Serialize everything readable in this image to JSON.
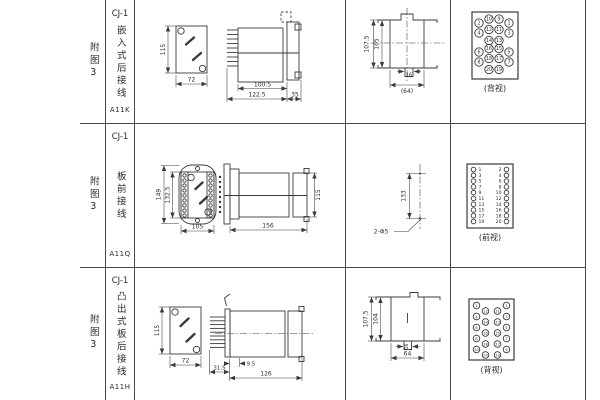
{
  "colors": {
    "background": "#ffffff",
    "line": "#3a3a3a",
    "text": "#2b2b2b"
  },
  "rows": [
    {
      "fig": "附图3",
      "model": "CJ-1",
      "mount_type": "嵌入式后接线",
      "code": "A11K",
      "front": {
        "height": "115",
        "width": "72"
      },
      "side": {
        "body_depth": "100.5",
        "total_depth": "122.5",
        "flange_depth": "35"
      },
      "cutout": {
        "outer_height": "107.5",
        "inner_height": "105",
        "tab": "16",
        "width": "(64)"
      },
      "terminal_view": {
        "caption": "(背视)",
        "numbers": [
          "2",
          "10",
          "9",
          "1",
          "4",
          "12",
          "11",
          "3",
          "14",
          "13",
          "6",
          "16",
          "15",
          "5",
          "8",
          "18",
          "17",
          "7",
          "20",
          "19"
        ]
      }
    },
    {
      "fig": "附图3",
      "model": "CJ-1",
      "mount_type": "板前接线",
      "code": "A11Q",
      "front": {
        "outer_height": "149",
        "inner_height": "132.5",
        "width": "105"
      },
      "side": {
        "length": "156",
        "height": "115"
      },
      "holes": {
        "pitch": "133",
        "label": "2-Φ5"
      },
      "terminal_view": {
        "caption": "(前视)",
        "numbers": [
          "1",
          "3",
          "5",
          "7",
          "9",
          "11",
          "13",
          "15",
          "17",
          "19",
          "2",
          "4",
          "6",
          "8",
          "10",
          "12",
          "14",
          "16",
          "18",
          "20"
        ]
      }
    },
    {
      "fig": "附图3",
      "model": "CJ-1",
      "mount_type": "凸出式板后接线",
      "code": "A11H",
      "front": {
        "height": "115",
        "width": "72"
      },
      "side": {
        "pin_depth": "31.5",
        "offset": "9.5",
        "length": "126"
      },
      "cutout": {
        "outer_height": "107.5",
        "inner_height": "104",
        "tab": "16",
        "width": "64"
      },
      "terminal_view": {
        "caption": "(背视)",
        "numbers": [
          "2",
          "4",
          "6",
          "8",
          "10",
          "12",
          "14",
          "16",
          "18",
          "20",
          "11",
          "13",
          "15",
          "17",
          "19",
          "1",
          "3",
          "5",
          "7",
          "9"
        ]
      }
    }
  ]
}
